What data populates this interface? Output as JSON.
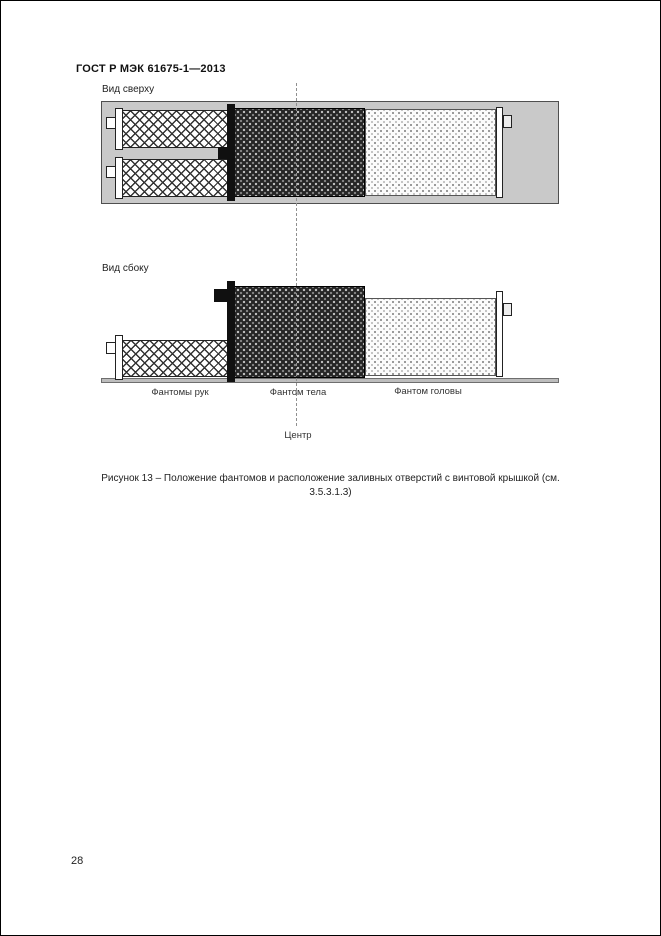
{
  "header": {
    "title": "ГОСТ Р МЭК 61675-1—2013"
  },
  "figure": {
    "views": {
      "top": "Вид сверху",
      "side": "Вид сбоку"
    },
    "labels": {
      "arms": "Фантомы рук",
      "body": "Фантом тела",
      "head": "Фантом головы",
      "center": "Центр"
    },
    "caption": {
      "line1": "Рисунок 13 – Положение фантомов и расположение заливных отверстий с винтовой крышкой (см.",
      "line2": "3.5.3.1.3)"
    }
  },
  "footer": {
    "page_number": "28"
  },
  "colors": {
    "page_border": "#000000",
    "container_fill": "#c9c9c9",
    "body_phantom": "#262626",
    "base_bar": "#bdbdbd"
  }
}
